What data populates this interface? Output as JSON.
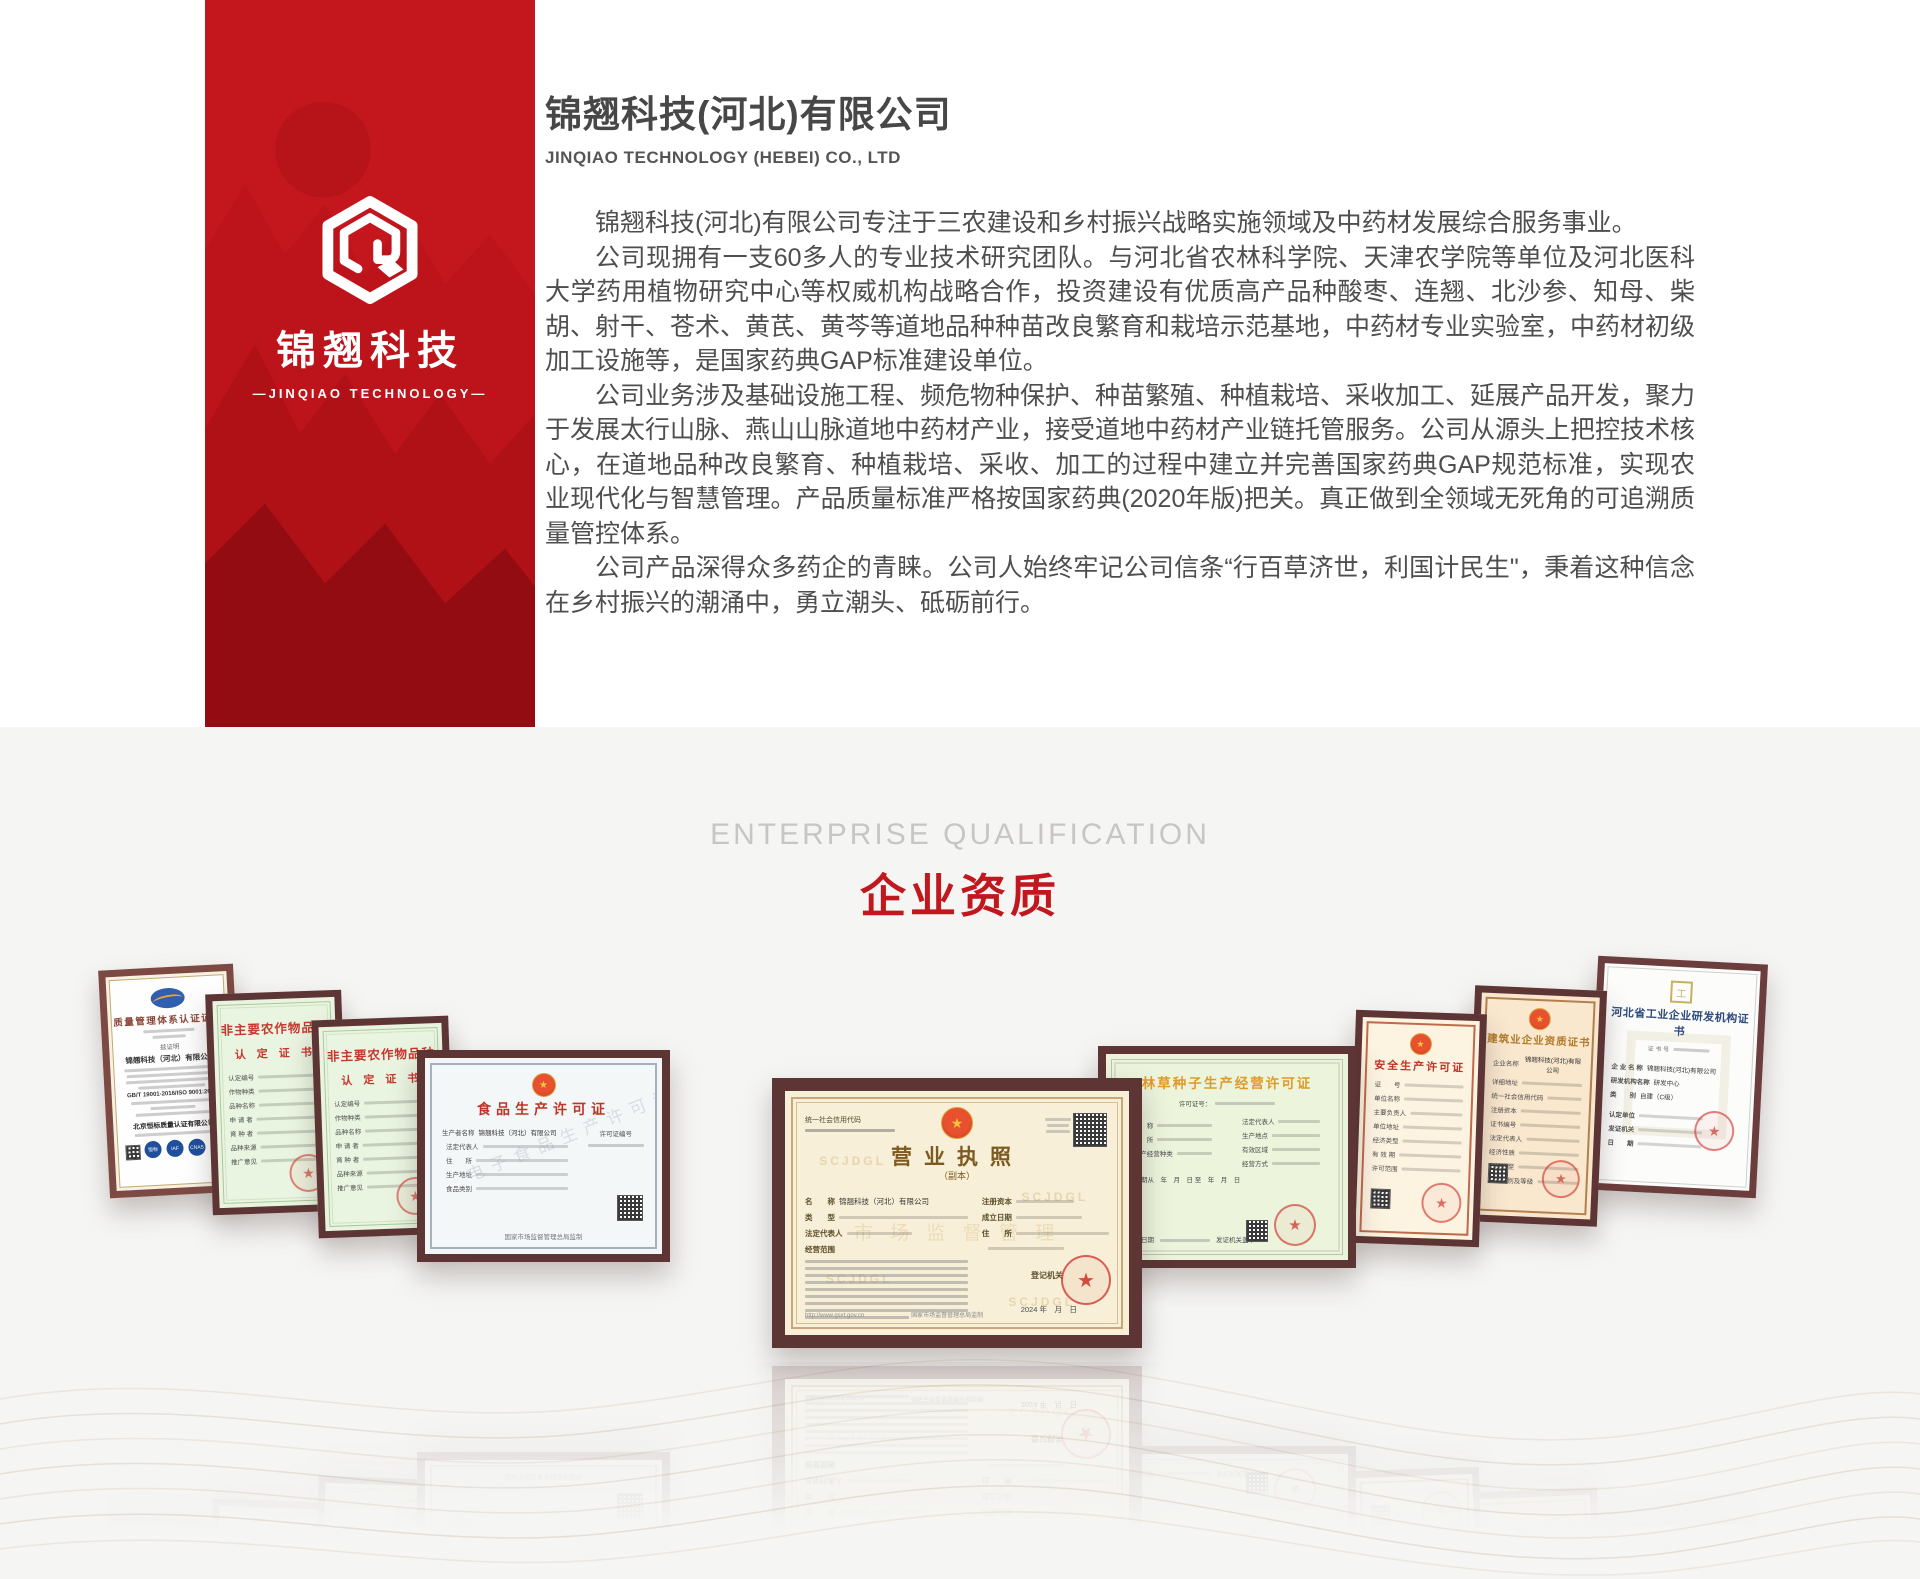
{
  "page": {
    "accent_red": "#c4161d",
    "section_bg": "#f5f5f3"
  },
  "banner": {
    "logo_cn": "锦翘科技",
    "logo_en": "—JINQIAO TECHNOLOGY—"
  },
  "intro": {
    "title_cn": "锦翘科技(河北)有限公司",
    "title_en": "JINQIAO TECHNOLOGY (HEBEI) CO., LTD",
    "paragraphs": [
      "锦翘科技(河北)有限公司专注于三农建设和乡村振兴战略实施领域及中药材发展综合服务事业。",
      "公司现拥有一支60多人的专业技术研究团队。与河北省农林科学院、天津农学院等单位及河北医科大学药用植物研究中心等权威机构战略合作，投资建设有优质高产品种酸枣、连翘、北沙参、知母、柴胡、射干、苍术、黄芪、黄芩等道地品种种苗改良繁育和栽培示范基地，中药材专业实验室，中药材初级加工设施等，是国家药典GAP标准建设单位。",
      "公司业务涉及基础设施工程、频危物种保护、种苗繁殖、种植栽培、采收加工、延展产品开发，聚力于发展太行山脉、燕山山脉道地中药材产业，接受道地中药材产业链托管服务。公司从源头上把控技术核心，在道地品种改良繁育、种植栽培、采收、加工的过程中建立并完善国家药典GAP规范标准，实现农业现代化与智慧管理。产品质量标准严格按国家药典(2020年版)把关。真正做到全领域无死角的可追溯质量管控体系。",
      "公司产品深得众多药企的青睐。公司人始终牢记公司信条“行百草济世，利国计民生\"，秉着这种信念在乡村振兴的潮涌中，勇立潮头、砥砺前行。"
    ]
  },
  "section": {
    "heading_en": "ENTERPRISE QUALIFICATION",
    "heading_cn": "企业资质"
  },
  "certificates": [
    {
      "title": "质量管理体系认证证书",
      "note": "兹证明",
      "company": "锦翘科技（河北）有限公司",
      "standard": "GB/T 19001-2016/ISO 9001:2015",
      "issuer": "北京恒标质量认证有限公司",
      "badges": [
        "恒标",
        "IAF",
        "CNAS"
      ]
    },
    {
      "title_line1": "非主要农作物品种",
      "title_line2": "认 定 证 书",
      "fields": [
        "认定编号",
        "作物种类",
        "品种名称",
        "申 请 者",
        "育 种 者",
        "品种来源",
        "推广意见"
      ]
    },
    {
      "title_line1": "非主要农作物品种",
      "title_line2": "认 定 证 书",
      "fields": [
        "认定编号",
        "作物种类",
        "品种名称",
        "申 请 者",
        "育 种 者",
        "品种来源",
        "推广意见"
      ]
    },
    {
      "title": "食品生产许可证",
      "license_label": "许可证编号",
      "company_label": "生产者名称",
      "company": "锦翘科技（河北）有限公司",
      "fields": [
        "法定代表人",
        "住　　所",
        "生产地址",
        "食品类别"
      ],
      "watermark": "电子食品生产许可证",
      "footer": "国家市场监督管理总局监制"
    },
    {
      "title": "营业执照",
      "subtitle": "（副本）",
      "code_label": "统一社会信用代码",
      "name_label": "名　　称",
      "company": "锦翘科技（河北）有限公司",
      "type_label": "类　　型",
      "legal_label": "法定代表人",
      "scope_label": "经营范围",
      "capital_label": "注册资本",
      "date_label": "成立日期",
      "address_label": "住　　所",
      "registrar_label": "登记机关",
      "date": "2024 年　月　日",
      "watermark": "SCJDGL",
      "watermark_center": "市 场 监 督 管 理",
      "url": "http://www.gsxt.gov.cn",
      "footer": "国家市场监督管理总局监制"
    },
    {
      "title": "林草种子生产经营许可证",
      "license_label": "许可证号：",
      "fields": [
        "名　称",
        "住　所",
        "生产经营种类",
        "法定代表人",
        "生产地点",
        "有效区域",
        "经营方式"
      ],
      "validity": "有效期从　年　月　日 至　年　月　日",
      "issuer_label": "发证机关盖章",
      "date_label": "发证日期"
    },
    {
      "title": "安全生产许可证",
      "fields": [
        "证　　号",
        "单位名称",
        "主要负责人",
        "单位地址",
        "经济类型",
        "有 效 期",
        "许可范围"
      ]
    },
    {
      "title": "建筑业企业资质证书",
      "company_label": "企业名称",
      "company": "锦翘科技(河北)有限公司",
      "fields": [
        "详细地址",
        "统一社会信用代码",
        "注册资本",
        "证书编号",
        "法定代表人",
        "经济性质",
        "有效期至",
        "资质类别及等级"
      ]
    },
    {
      "title": "河北省工业企业研发机构证书",
      "cert_no_label": "证 书 号",
      "fields": [
        {
          "label": "企 业 名 称",
          "value": "锦翘科技(河北)有限公司"
        },
        {
          "label": "研发机构名称",
          "value": "研发中心"
        },
        {
          "label": "类　　别",
          "value": "自建（C级）"
        }
      ],
      "footer_rows": [
        "认定单位",
        "发证机关",
        "日　　期"
      ]
    }
  ]
}
